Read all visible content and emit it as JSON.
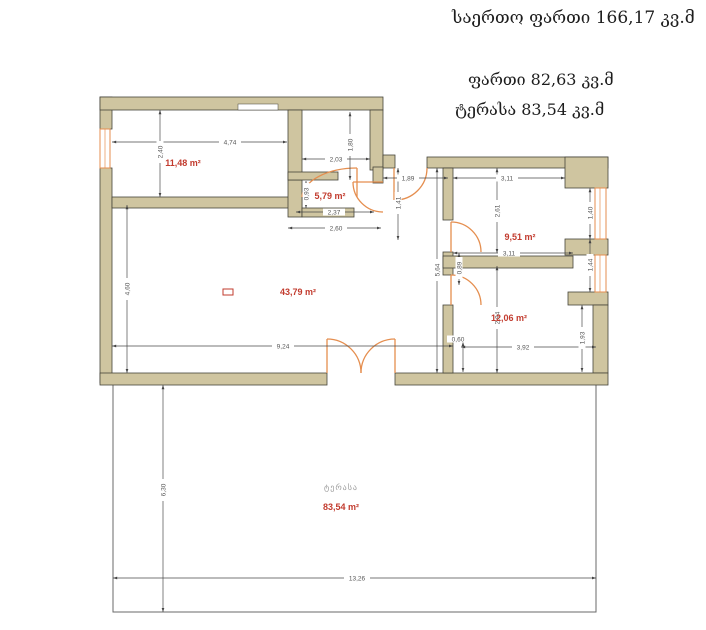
{
  "header": {
    "total": "საერთო ფართი  166,17 კვ.მ",
    "inner_area": "ფართი 82,63 კვ.მ",
    "terrace_area": "ტერასა 83,54 კვ.მ"
  },
  "plan": {
    "rooms": {
      "bedroom": "11,48 m²",
      "bath": "5,79 m²",
      "living": "43,79 m²",
      "room_right_top": "9,51 m²",
      "room_right_bottom": "12,06 m²"
    },
    "terrace": {
      "name": "ტერასა",
      "area": "83,54 m²"
    },
    "dims": {
      "w474": "4,74",
      "w203": "2,03",
      "w237": "2,37",
      "w260": "2,60",
      "w189": "1,89",
      "w311a": "3,11",
      "w311b": "3,11",
      "w924": "9,24",
      "w392": "3,92",
      "w1326": "13,26",
      "h240": "2,40",
      "h460": "4,60",
      "h180": "1,80",
      "h093": "0,93",
      "h141": "1,41",
      "h564": "5,64",
      "h261": "2,61",
      "h089": "0,89",
      "h294": "2,94",
      "h140": "1,40",
      "h144": "1,44",
      "h193": "1,93",
      "h630": "6,30",
      "h060": "0,60"
    },
    "colors": {
      "wall": "#cfc5a0",
      "accent": "#e58e4f",
      "area_label": "#c23b2e",
      "dim": "#4a4a4a",
      "terrace_label": "#9a9a9a"
    }
  }
}
